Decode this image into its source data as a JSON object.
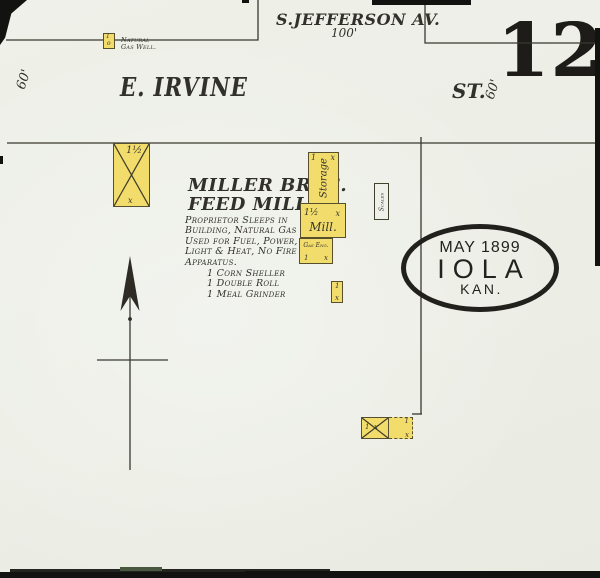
{
  "sheet": {
    "number": "12"
  },
  "stamp": {
    "date": "MAY 1899",
    "city": "IOLA",
    "state": "KAN."
  },
  "streets": {
    "jefferson": {
      "name": "S.JEFFERSON AV.",
      "width": "100'"
    },
    "irvine": {
      "name": "E. IRVINE",
      "suffix": "ST.",
      "width_west": "60'",
      "width_east": "60'"
    }
  },
  "gas_well": {
    "label_line1": "Natural",
    "label_line2": "Gas Well.",
    "story": "1",
    "mark": "o"
  },
  "mill_text": {
    "title1": "MILLER BROS.",
    "title2": "FEED MILL",
    "notes": [
      "Proprietor Sleeps in",
      "Building, Natural Gas",
      "Used for Fuel, Power,",
      "Light & Heat, No Fire",
      "Apparatus."
    ],
    "equipment": [
      "1 Corn Sheller",
      "1 Double Roll",
      "1 Meal Grinder"
    ]
  },
  "buildings": {
    "derrick": {
      "stories": "1½",
      "mark": "x"
    },
    "storage": {
      "label": "Storage",
      "stories": "1",
      "mark": "x"
    },
    "mill": {
      "label": "Mill.",
      "stories": "1½",
      "mark": "x"
    },
    "gas_engine": {
      "label": "Gas Eng.",
      "stories": "1",
      "mark": "x"
    },
    "shed": {
      "stories": "1",
      "mark": "x"
    },
    "scales": {
      "label": "Scales"
    },
    "barn": {
      "stories": "1",
      "mark": "x"
    },
    "barn_ext": {
      "stories": "1",
      "mark": "x"
    }
  },
  "colors": {
    "paper": "#edefe8",
    "building_yellow": "#f1dc6c",
    "ink": "#32302a",
    "stamp_black": "#21201c"
  }
}
